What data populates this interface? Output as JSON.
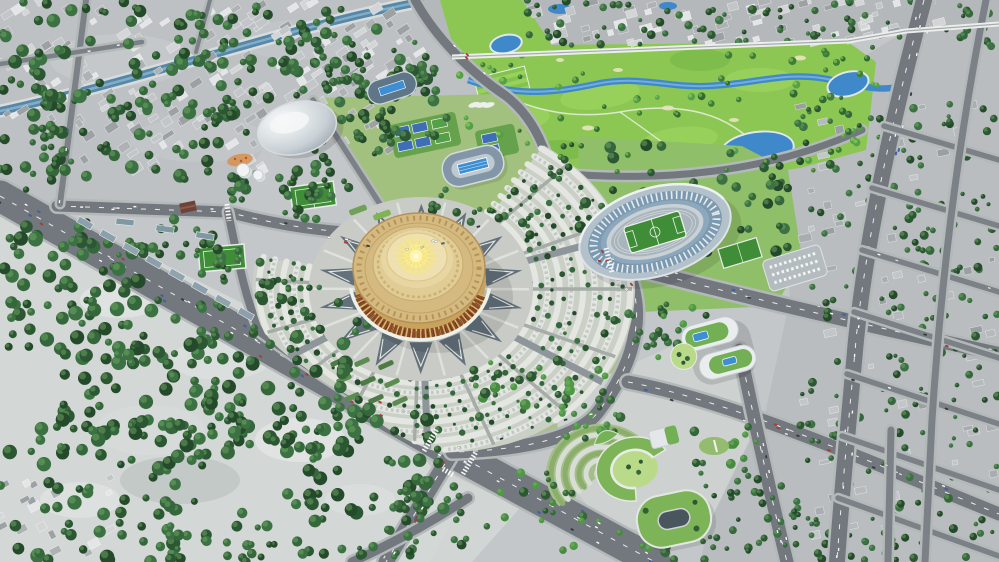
{
  "meta": {
    "scene_label": "Aerial 3D render of a city masterplan with a golden circular arena, oval stadium, golf course, parks and road network"
  },
  "landmarks": {
    "scene": "city masterplan aerial render",
    "arena": "golden circular arena with sunburst roof",
    "plaza": "ornamental plaza ring with triangle motifs",
    "fan": "radial parking arcs around arena",
    "stadium": "oval football stadium with green pitch",
    "practice": "practice football pitch",
    "velodrome": "white domed sports hall",
    "aquatics1": "oval aquatics centre with outdoor pool",
    "aquatics2": "pool pavilion with blue roof strip",
    "golf": "golf course with river and ponds",
    "oldcity": "existing low-rise city fabric",
    "forest": "forest park",
    "grid": "tree-filled city block grid",
    "campus": "green-roof campus buildings",
    "sbuilding": "curved white building with rooftop pools",
    "cbuilding": "crescent building with courtyard lawn",
    "obuilding": "ring building with inner courtyard",
    "amphitheater": "terraced garden amphitheater",
    "river": "canal through old city",
    "avenue": "main diagonal avenue"
  },
  "palette": {
    "base": "#c3c7c9",
    "cityBase": "#bdc1c3",
    "neBase": "#b4b8ba",
    "gridBase": "#b9bdbf",
    "forestGround": "#d3d8d6",
    "mallLight": "#d3d7d5",
    "roadHalo": "#b3b8b9",
    "road": "#73787e",
    "roadMinor": "#7b8186",
    "dash": "#ffffff",
    "riverWater": "#5687a8",
    "riverHL": "#86b1c9",
    "golfWater": "#3f88c9",
    "golfWaterHL": "#7fb7e0",
    "pondEdge": "#dfe8ec",
    "golf": "#8cc653",
    "golfLight": "#a4d966",
    "golfDark": "#6db044",
    "sand": "#e9e3c0",
    "fanBase": "#cbd0c7",
    "fanRow": "#e3e6e1",
    "fanDash": "#c2c8c4",
    "fanLane": "#a6aca7",
    "fanRoad": "#8f969b",
    "plazaBase": "#c9ccc6",
    "plazaTri": "#5b6974",
    "plazaPath": "#dfe2dc",
    "plazaChevron": "#e8eae6",
    "arenaGold": "#c7a35d",
    "roofGold": "#d4ba80",
    "roofOrn": "#b08c50",
    "roofMid": "#e0cc95",
    "roofPad": "#eee0b0",
    "facadeMaroon": "#8a4c28",
    "facadePillar": "#d9b66e",
    "facadeDark": "#5e2d17",
    "rimWhite": "#eef0ea",
    "sunRay": "#f2d43d",
    "sunRay2": "#f7e158",
    "sunGlow": "#f6e87f",
    "sunCore": "#fff3b0",
    "lawn": "#a3c17e",
    "lawnBright": "#8fbf68",
    "parkGreen": "#a9c08b",
    "campusPlaza": "#cdd2d0",
    "pitch": "#3f8d37",
    "pitchLine": "#e8f0e8",
    "court": "#3e6fb6",
    "courtGreen": "#55a047",
    "courtBg": "#66a14c",
    "bowlOuter": "#b3c1cb",
    "bowlTier": "#7b99b0",
    "bowlTier2": "#8ea8bb",
    "bowlRim": "#c9d1d7",
    "track": "#a9b5bd",
    "domeLight": "#fbfcfc",
    "domeDark": "#9fa9b1",
    "aquaBody": "#8296a8",
    "aquaBody2": "#5f7689",
    "pool": "#3c8fd2",
    "deck": "#bfc9d1",
    "roofGreen": "#73b055",
    "roofGreen2": "#7cb457",
    "lawnCourt": "#b9da88",
    "holeDark": "#49565e",
    "slabWhite": "#e9edee",
    "amphiBase": "#a5bf88",
    "amphiStep": "#d8ded6",
    "amphiGreen": "#8cae6d",
    "hedge1": "#4e7b45",
    "hedge2": "#5c8c4f",
    "wallWhite": "#eceeec",
    "treePalettes": {
      "dark": [
        "#2c5733",
        "#35663c",
        "#244a2b",
        "#3c7243"
      ],
      "golf": [
        "#3e7d38",
        "#55a046",
        "#2f6b30"
      ],
      "mixed": [
        "#35663c",
        "#4e9a44",
        "#2c5733",
        "#478a42"
      ]
    },
    "treeHighlight": {
      "dark": "#6fa763",
      "golf": "#a4da70",
      "mixed": "#7fb46c"
    },
    "buildingSets": {
      "gray": [
        "#d3d5d7",
        "#c3c6c8",
        "#afb2b5",
        "#e4e5e7",
        "#9da1a4"
      ],
      "muted": [
        "#a8adaf",
        "#b6babc",
        "#9a9fa2",
        "#c2c6c8"
      ]
    },
    "carColors": [
      "#ffffff",
      "#ffffff",
      "#f2f2f2",
      "#2f3438",
      "#c03428",
      "#3563b8",
      "#dddddd",
      "#ffffff"
    ]
  },
  "fan": {
    "cx": 421,
    "cy": 289,
    "ry": 0.82,
    "r0": 108,
    "r1": 214,
    "rings": 9,
    "a0": -55,
    "a1": 196,
    "minorStep": 23,
    "majors": [
      -18,
      32,
      88,
      148
    ],
    "rout": [
      [
        -55,
        216
      ],
      [
        20,
        216
      ],
      [
        60,
        210
      ],
      [
        85,
        200
      ],
      [
        100,
        175
      ],
      [
        118,
        148
      ],
      [
        140,
        150
      ],
      [
        162,
        166
      ],
      [
        196,
        170
      ]
    ]
  },
  "plaza": {
    "cx": 421,
    "cy": 289,
    "ry": 0.82,
    "count": 14,
    "rIn": 66,
    "rOut": 104,
    "walkR0": 62,
    "walkR1": 108
  },
  "sun": {
    "cx": 416,
    "cy": 256,
    "ry": 0.8,
    "n": 18,
    "rLong": 23,
    "rShort": 15
  },
  "amphi": {
    "cx": 602,
    "cy": 474,
    "ry": 0.9,
    "a0": 140,
    "a1": 322,
    "radii": [
      16,
      23,
      30,
      37,
      44,
      51
    ]
  },
  "cring": {
    "rO": 38,
    "rI": 22,
    "ry": 0.84,
    "a0": 95,
    "a1": 335
  },
  "scatter": {
    "trees": [
      {
        "x": 0,
        "y": 0,
        "w": 210,
        "h": 118,
        "n": 60,
        "r0": 3,
        "r1": 7,
        "p": "dark"
      },
      {
        "x": 180,
        "y": 0,
        "w": 170,
        "h": 72,
        "n": 40,
        "r0": 3,
        "r1": 6,
        "p": "dark"
      },
      {
        "x": 40,
        "y": 92,
        "w": 205,
        "h": 88,
        "n": 48,
        "r0": 3,
        "r1": 7,
        "p": "dark"
      },
      {
        "x": 215,
        "y": 58,
        "w": 150,
        "h": 88,
        "n": 38,
        "r0": 3,
        "r1": 6,
        "p": "dark"
      },
      {
        "x": 300,
        "y": 18,
        "w": 135,
        "h": 72,
        "n": 30,
        "r0": 3,
        "r1": 6,
        "p": "dark"
      },
      {
        "x": 355,
        "y": 78,
        "w": 95,
        "h": 62,
        "n": 22,
        "r0": 3,
        "r1": 6,
        "p": "dark"
      },
      {
        "x": 228,
        "y": 138,
        "w": 112,
        "h": 62,
        "n": 26,
        "r0": 3,
        "r1": 6,
        "p": "dark"
      },
      {
        "x": 0,
        "y": 112,
        "w": 62,
        "h": 78,
        "n": 16,
        "r0": 3,
        "r1": 6,
        "p": "dark"
      },
      {
        "x": 522,
        "y": 0,
        "w": 200,
        "h": 48,
        "n": 34,
        "r0": 2,
        "r1": 4.5,
        "p": "dark"
      },
      {
        "x": 700,
        "y": 0,
        "w": 150,
        "h": 42,
        "n": 26,
        "r0": 2,
        "r1": 4.5,
        "p": "dark"
      },
      {
        "x": 845,
        "y": 0,
        "w": 154,
        "h": 50,
        "n": 28,
        "r0": 2,
        "r1": 4.5,
        "p": "dark"
      },
      {
        "x": 458,
        "y": 48,
        "w": 400,
        "h": 126,
        "n": 55,
        "r0": 2,
        "r1": 4,
        "p": "golf"
      },
      {
        "x": 820,
        "y": 50,
        "w": 60,
        "h": 110,
        "n": 14,
        "r0": 2,
        "r1": 4,
        "p": "golf"
      },
      {
        "x": 578,
        "y": 140,
        "w": 210,
        "h": 112,
        "n": 48,
        "r0": 3,
        "r1": 6,
        "p": "dark"
      },
      {
        "x": 600,
        "y": 300,
        "w": 110,
        "h": 44,
        "n": 14,
        "r0": 2.5,
        "r1": 5,
        "p": "dark"
      },
      {
        "x": 798,
        "y": 92,
        "w": 201,
        "h": 468,
        "n": 240,
        "r0": 2,
        "r1": 4.5,
        "p": "dark"
      },
      {
        "x": 700,
        "y": 470,
        "w": 100,
        "h": 92,
        "n": 40,
        "r0": 2,
        "r1": 4.5,
        "p": "dark"
      },
      {
        "x": 0,
        "y": 225,
        "w": 145,
        "h": 125,
        "n": 64,
        "r0": 3.5,
        "r1": 7.5,
        "p": "dark"
      },
      {
        "x": 60,
        "y": 300,
        "w": 185,
        "h": 135,
        "n": 78,
        "r0": 3.5,
        "r1": 7.5,
        "p": "dark"
      },
      {
        "x": 185,
        "y": 335,
        "w": 180,
        "h": 120,
        "n": 66,
        "r0": 3.5,
        "r1": 7.5,
        "p": "dark"
      },
      {
        "x": 285,
        "y": 405,
        "w": 160,
        "h": 110,
        "n": 55,
        "r0": 3.5,
        "r1": 7,
        "p": "dark"
      },
      {
        "x": 385,
        "y": 475,
        "w": 85,
        "h": 70,
        "n": 26,
        "r0": 3,
        "r1": 6,
        "p": "dark"
      },
      {
        "x": 0,
        "y": 415,
        "w": 205,
        "h": 145,
        "n": 72,
        "r0": 3.5,
        "r1": 7.5,
        "p": "dark"
      },
      {
        "x": 150,
        "y": 505,
        "w": 175,
        "h": 57,
        "n": 36,
        "r0": 3,
        "r1": 6.5,
        "p": "dark"
      },
      {
        "x": 330,
        "y": 545,
        "w": 90,
        "h": 17,
        "n": 10,
        "r0": 2.5,
        "r1": 5,
        "p": "dark"
      },
      {
        "x": 78,
        "y": 218,
        "w": 150,
        "h": 48,
        "n": 20,
        "r0": 2.5,
        "r1": 5.5,
        "p": "dark"
      },
      {
        "x": 282,
        "y": 170,
        "w": 72,
        "h": 52,
        "n": 18,
        "r0": 2.5,
        "r1": 5,
        "p": "dark"
      },
      {
        "x": 186,
        "y": 238,
        "w": 88,
        "h": 52,
        "n": 16,
        "r0": 2.5,
        "r1": 5,
        "p": "dark"
      },
      {
        "x": 252,
        "y": 278,
        "w": 115,
        "h": 62,
        "n": 24,
        "r0": 2.5,
        "r1": 5.5,
        "p": "dark"
      },
      {
        "x": 318,
        "y": 104,
        "w": 80,
        "h": 55,
        "n": 16,
        "r0": 2.5,
        "r1": 5,
        "p": "dark"
      },
      {
        "x": 430,
        "y": 185,
        "w": 115,
        "h": 50,
        "n": 20,
        "r0": 2.5,
        "r1": 5,
        "p": "dark"
      },
      {
        "x": 540,
        "y": 140,
        "w": 45,
        "h": 40,
        "n": 8,
        "r0": 2,
        "r1": 4,
        "p": "dark"
      },
      {
        "x": 340,
        "y": 40,
        "w": 120,
        "h": 58,
        "n": 14,
        "r0": 2.5,
        "r1": 5,
        "p": "dark"
      },
      {
        "x": 470,
        "y": 360,
        "w": 145,
        "h": 75,
        "n": 30,
        "r0": 2.5,
        "r1": 5.5,
        "p": "mixed"
      },
      {
        "x": 560,
        "y": 382,
        "w": 62,
        "h": 58,
        "n": 15,
        "r0": 2.5,
        "r1": 5,
        "p": "mixed"
      },
      {
        "x": 688,
        "y": 422,
        "w": 70,
        "h": 48,
        "n": 12,
        "r0": 2.5,
        "r1": 5,
        "p": "mixed"
      },
      {
        "x": 640,
        "y": 300,
        "w": 62,
        "h": 58,
        "n": 13,
        "r0": 2.5,
        "r1": 5,
        "p": "mixed"
      },
      {
        "x": 482,
        "y": 470,
        "w": 115,
        "h": 58,
        "n": 18,
        "r0": 2.5,
        "r1": 5,
        "p": "mixed"
      },
      {
        "x": 560,
        "y": 518,
        "w": 115,
        "h": 42,
        "n": 14,
        "r0": 2.5,
        "r1": 5,
        "p": "mixed"
      }
    ],
    "buildings": [
      {
        "x": 0,
        "y": 0,
        "w": 220,
        "h": 120,
        "n": 60,
        "rot": -33,
        "set": "gray"
      },
      {
        "x": 200,
        "y": 0,
        "w": 200,
        "h": 80,
        "n": 45,
        "rot": -33,
        "set": "gray"
      },
      {
        "x": 50,
        "y": 90,
        "w": 220,
        "h": 80,
        "n": 40,
        "rot": -33,
        "set": "gray"
      },
      {
        "x": 250,
        "y": 70,
        "w": 160,
        "h": 80,
        "n": 30,
        "rot": -33,
        "set": "gray"
      },
      {
        "x": 340,
        "y": 20,
        "w": 100,
        "h": 60,
        "n": 18,
        "rot": -33,
        "set": "gray"
      },
      {
        "x": 522,
        "y": 0,
        "w": 470,
        "h": 46,
        "n": 70,
        "rot": -15,
        "set": "gray"
      },
      {
        "x": 0,
        "y": 470,
        "w": 120,
        "h": 90,
        "n": 18,
        "rot": -28,
        "set": "gray"
      },
      {
        "x": 798,
        "y": 100,
        "w": 200,
        "h": 450,
        "n": 60,
        "rot": -12,
        "set": "muted"
      }
    ],
    "cars": [
      {
        "x1": 0,
        "y1": 196,
        "x2": 452,
        "y2": 452,
        "n": 24,
        "s": 12
      },
      {
        "x1": 452,
        "y1": 452,
        "x2": 655,
        "y2": 562,
        "n": 14,
        "s": 12
      },
      {
        "x1": 452,
        "y1": 452,
        "x2": 386,
        "y2": 562,
        "n": 7,
        "s": 5
      },
      {
        "x1": 57,
        "y1": 206,
        "x2": 228,
        "y2": 212,
        "n": 5,
        "s": 3.5
      },
      {
        "x1": 228,
        "y1": 212,
        "x2": 402,
        "y2": 252,
        "n": 6,
        "s": 3.5
      },
      {
        "x1": 402,
        "y1": 252,
        "x2": 557,
        "y2": 206,
        "n": 6,
        "s": 3.5
      },
      {
        "x1": 596,
        "y1": 258,
        "x2": 800,
        "y2": 306,
        "n": 9,
        "s": 5
      },
      {
        "x1": 800,
        "y1": 306,
        "x2": 999,
        "y2": 354,
        "n": 7,
        "s": 5
      },
      {
        "x1": 628,
        "y1": 382,
        "x2": 820,
        "y2": 442,
        "n": 8,
        "s": 4.5
      },
      {
        "x1": 820,
        "y1": 442,
        "x2": 999,
        "y2": 512,
        "n": 6,
        "s": 4.5
      },
      {
        "x1": 740,
        "y1": 350,
        "x2": 787,
        "y2": 562,
        "n": 9,
        "s": 4.5
      },
      {
        "x1": 924,
        "y1": 0,
        "x2": 856,
        "y2": 340,
        "n": 9,
        "s": 6
      },
      {
        "x1": 856,
        "y1": 340,
        "x2": 837,
        "y2": 562,
        "n": 7,
        "s": 6
      },
      {
        "x1": 557,
        "y1": 206,
        "x2": 640,
        "y2": 300,
        "n": 4,
        "s": 4
      },
      {
        "x1": 598,
        "y1": 412,
        "x2": 452,
        "y2": 452,
        "n": 3,
        "s": 4
      },
      {
        "x1": 415,
        "y1": 0,
        "x2": 506,
        "y2": 96,
        "n": 4,
        "s": 3
      },
      {
        "x1": 862,
        "y1": 250,
        "x2": 999,
        "y2": 292,
        "n": 3,
        "s": 2
      },
      {
        "x1": 846,
        "y1": 376,
        "x2": 999,
        "y2": 424,
        "n": 3,
        "s": 2
      },
      {
        "x1": 0,
        "y1": 64,
        "x2": 140,
        "y2": 42,
        "n": 2,
        "s": 1.5
      },
      {
        "x1": 86,
        "y1": 0,
        "x2": 60,
        "y2": 204,
        "n": 3,
        "s": 2
      }
    ]
  }
}
